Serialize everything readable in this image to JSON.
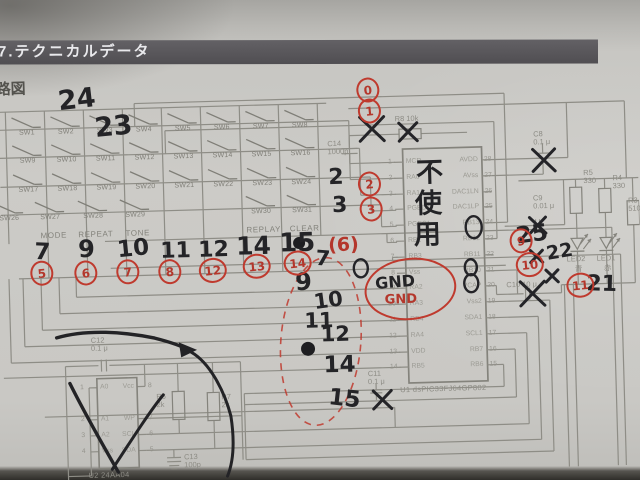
{
  "photo": {
    "header_title": "7.テクニカルデータ",
    "page_label": "路図"
  },
  "switch_matrix": {
    "rows": [
      [
        "SW1",
        "SW2",
        "SW3",
        "SW4",
        "SW5",
        "SW6",
        "SW7",
        "SW8"
      ],
      [
        "SW9",
        "SW10",
        "SW11",
        "SW12",
        "SW13",
        "SW14",
        "SW15",
        "SW16"
      ],
      [
        "SW17",
        "SW18",
        "SW19",
        "SW20",
        "SW21",
        "SW22",
        "SW23",
        "SW24"
      ],
      [
        "SW26",
        "SW27",
        "SW28",
        "SW29",
        "SW30",
        "SW31"
      ]
    ],
    "function_labels": [
      "MODE",
      "REPEAT",
      "TONE",
      "REPLAY",
      "CLEAR"
    ]
  },
  "ic_u1": {
    "name": "U1  dsPIC33FJ64GP802",
    "left_pins": [
      {
        "num": "1",
        "label": "MCR"
      },
      {
        "num": "2",
        "label": "RA0"
      },
      {
        "num": "3",
        "label": "RA1"
      },
      {
        "num": "4",
        "label": "PGED1"
      },
      {
        "num": "5",
        "label": "PGEC1"
      },
      {
        "num": "6",
        "label": "RB2"
      },
      {
        "num": "7",
        "label": "RB3"
      },
      {
        "num": "8",
        "label": "Vss"
      },
      {
        "num": "9",
        "label": "RA2"
      },
      {
        "num": "10",
        "label": "RA3"
      },
      {
        "num": "11",
        "label": "RB4"
      },
      {
        "num": "12",
        "label": "RA4"
      },
      {
        "num": "13",
        "label": "VDD"
      },
      {
        "num": "14",
        "label": "RB5"
      }
    ],
    "right_pins": [
      {
        "num": "28",
        "label": "AVDD"
      },
      {
        "num": "27",
        "label": "AVss"
      },
      {
        "num": "26",
        "label": "DAC1LN"
      },
      {
        "num": "25",
        "label": "DAC1LP"
      },
      {
        "num": "24",
        "label": "RB13"
      },
      {
        "num": "23",
        "label": "RB12"
      },
      {
        "num": "22",
        "label": "RB11"
      },
      {
        "num": "21",
        "label": "RB10"
      },
      {
        "num": "20",
        "label": "VCAP"
      },
      {
        "num": "19",
        "label": "Vss2"
      },
      {
        "num": "18",
        "label": "SDA1"
      },
      {
        "num": "17",
        "label": "SCL1"
      },
      {
        "num": "16",
        "label": "RB7"
      },
      {
        "num": "15",
        "label": "RB6"
      }
    ]
  },
  "ic_u2": {
    "name": "U2  24AA04",
    "left_pins": [
      {
        "num": "1",
        "label": "A0"
      },
      {
        "num": "2",
        "label": "A1"
      },
      {
        "num": "3",
        "label": "A2"
      },
      {
        "num": "4",
        "label": "Vss"
      }
    ],
    "right_pins": [
      {
        "num": "8",
        "label": "Vcc"
      },
      {
        "num": "7",
        "label": "WP"
      },
      {
        "num": "6",
        "label": "SCL"
      },
      {
        "num": "5",
        "label": "SDA"
      }
    ]
  },
  "components": [
    {
      "id": "c14",
      "t": "C14\n1000p",
      "x": 330,
      "y": 141
    },
    {
      "id": "r8",
      "t": "R8 10k",
      "x": 398,
      "y": 118
    },
    {
      "id": "c8",
      "t": "C8\n0.1 μ",
      "x": 536,
      "y": 137
    },
    {
      "id": "c9",
      "t": "C9\n0.01 μ",
      "x": 534,
      "y": 201
    },
    {
      "id": "c10",
      "t": "C10  10 μ",
      "x": 505,
      "y": 287
    },
    {
      "id": "c11",
      "t": "C11\n0.1 μ",
      "x": 364,
      "y": 372
    },
    {
      "id": "c12",
      "t": "C12\n0.1 μ",
      "x": 88,
      "y": 331
    },
    {
      "id": "c13",
      "t": "C13\n100p",
      "x": 178,
      "y": 450
    },
    {
      "id": "r5",
      "t": "R5\n330",
      "x": 585,
      "y": 177
    },
    {
      "id": "r4",
      "t": "R4\n330",
      "x": 614,
      "y": 183
    },
    {
      "id": "r3",
      "t": "R3\n510",
      "x": 629,
      "y": 206
    },
    {
      "id": "r6",
      "t": "R6\n2k",
      "x": 152,
      "y": 389
    },
    {
      "id": "r7",
      "t": "R7\n2k",
      "x": 217,
      "y": 391
    },
    {
      "id": "led2",
      "t": "LED2",
      "x": 566,
      "y": 263
    },
    {
      "id": "led2-color",
      "t": "青",
      "x": 574,
      "y": 273
    },
    {
      "id": "led1",
      "t": "LED1",
      "x": 596,
      "y": 263
    },
    {
      "id": "led1-color",
      "t": "赤",
      "x": 603,
      "y": 273
    }
  ],
  "handwritten": {
    "black_numbers": [
      {
        "t": "24",
        "x": 62,
        "y": 80,
        "s": 27,
        "r": -5
      },
      {
        "t": "23",
        "x": 98,
        "y": 108,
        "s": 27,
        "r": -4
      },
      {
        "t": "2",
        "x": 330,
        "y": 168,
        "s": 22,
        "r": 0
      },
      {
        "t": "3",
        "x": 333,
        "y": 196,
        "s": 22,
        "r": 0
      },
      {
        "t": "7",
        "x": 34,
        "y": 234,
        "s": 23,
        "r": 4
      },
      {
        "t": "9",
        "x": 78,
        "y": 231,
        "s": 24,
        "r": 0
      },
      {
        "t": "10",
        "x": 117,
        "y": 233,
        "s": 23,
        "r": -4
      },
      {
        "t": "11",
        "x": 160,
        "y": 237,
        "s": 22,
        "r": 0
      },
      {
        "t": "12",
        "x": 198,
        "y": 237,
        "s": 22,
        "r": 0
      },
      {
        "t": "14",
        "x": 236,
        "y": 232,
        "s": 25,
        "r": 0
      },
      {
        "t": "15",
        "x": 279,
        "y": 230,
        "s": 26,
        "r": 0
      },
      {
        "t": "7",
        "x": 315,
        "y": 249,
        "s": 21,
        "r": 6
      },
      {
        "t": "9",
        "x": 294,
        "y": 270,
        "s": 24,
        "r": 0
      },
      {
        "t": "10",
        "x": 312,
        "y": 291,
        "s": 21,
        "r": -6
      },
      {
        "t": "11",
        "x": 302,
        "y": 311,
        "s": 21,
        "r": 0
      },
      {
        "t": "12",
        "x": 318,
        "y": 325,
        "s": 21,
        "r": 0
      },
      {
        "t": "14",
        "x": 320,
        "y": 355,
        "s": 23,
        "r": 0
      },
      {
        "t": "15",
        "x": 324,
        "y": 389,
        "s": 23,
        "r": 8
      },
      {
        "t": "25",
        "x": 516,
        "y": 230,
        "s": 23,
        "r": -6
      },
      {
        "t": "22",
        "x": 546,
        "y": 250,
        "s": 19,
        "r": -8
      },
      {
        "t": "21",
        "x": 585,
        "y": 282,
        "s": 22,
        "r": 3
      },
      {
        "t": "GND",
        "x": 374,
        "y": 277,
        "s": 16,
        "r": -3
      }
    ],
    "not_used_vertical": [
      "不",
      "使",
      "用"
    ],
    "red_circled": [
      {
        "t": "0",
        "x": 372,
        "y": 92
      },
      {
        "t": "1",
        "x": 373,
        "y": 113
      },
      {
        "t": "2",
        "x": 371,
        "y": 186
      },
      {
        "t": "3",
        "x": 372,
        "y": 211
      },
      {
        "t": "5",
        "x": 41,
        "y": 266
      },
      {
        "t": "6",
        "x": 85,
        "y": 267
      },
      {
        "t": "7",
        "x": 127,
        "y": 267
      },
      {
        "t": "8",
        "x": 169,
        "y": 268
      },
      {
        "t": "12",
        "x": 212,
        "y": 268
      },
      {
        "t": "13",
        "x": 256,
        "y": 265
      },
      {
        "t": "14",
        "x": 297,
        "y": 263
      },
      {
        "t": "9",
        "x": 521,
        "y": 247
      },
      {
        "t": "10",
        "x": 529,
        "y": 271
      },
      {
        "t": "11",
        "x": 579,
        "y": 293
      }
    ],
    "red_texts": [
      {
        "t": "(6)",
        "x": 328,
        "y": 237,
        "s": 19
      },
      {
        "t": "GND",
        "x": 383,
        "y": 296,
        "s": 13
      }
    ]
  }
}
